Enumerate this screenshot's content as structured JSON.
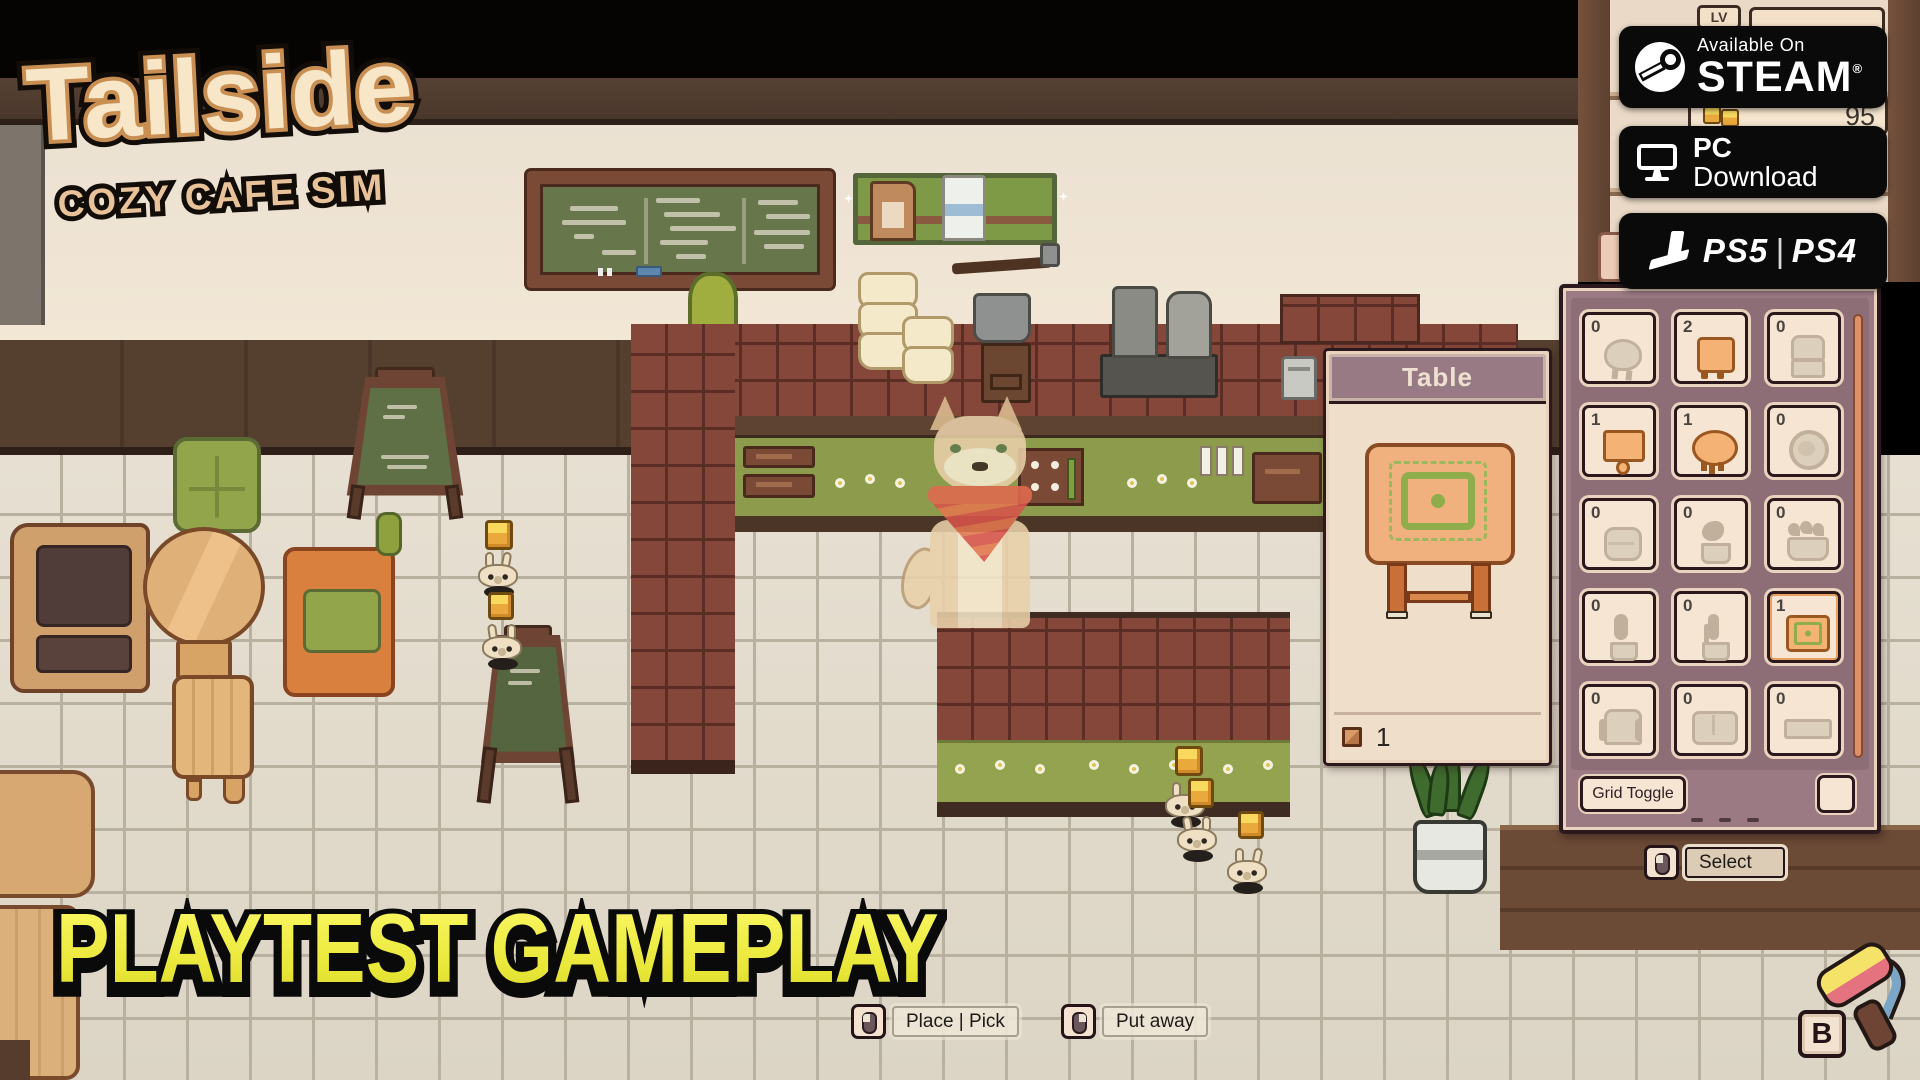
{
  "branding": {
    "logo_title": "Tailside",
    "logo_subtitle": "COZY CAFE SIM",
    "watermark": "PLAYTEST GAMEPLAY"
  },
  "platform_badges": {
    "steam": {
      "icon": "steam-logo",
      "line1": "Available On",
      "line2": "STEAM",
      "registered": "®"
    },
    "pc": {
      "icon": "monitor-icon",
      "line1": "PC",
      "line2": "Download"
    },
    "playstation": {
      "icon": "playstation-logo",
      "primary": "PS5",
      "divider": "|",
      "secondary": "PS4"
    }
  },
  "hud": {
    "level_label": "LV",
    "coin_icon": "coin-icon",
    "currency_value": "95"
  },
  "item_popup": {
    "title": "Table",
    "count_icon": "furniture-box-icon",
    "count": "1"
  },
  "inventory_panel": {
    "slots": [
      {
        "count": "0",
        "item": "stool-round",
        "state": "empty"
      },
      {
        "count": "2",
        "item": "stool-square",
        "state": "available"
      },
      {
        "count": "0",
        "item": "chair",
        "state": "empty"
      },
      {
        "count": "1",
        "item": "table-square",
        "state": "available"
      },
      {
        "count": "1",
        "item": "table-round",
        "state": "available"
      },
      {
        "count": "0",
        "item": "chair-round",
        "state": "empty"
      },
      {
        "count": "0",
        "item": "pouf",
        "state": "empty"
      },
      {
        "count": "0",
        "item": "plant-small",
        "state": "empty"
      },
      {
        "count": "0",
        "item": "planter",
        "state": "empty"
      },
      {
        "count": "0",
        "item": "plant-tall",
        "state": "empty"
      },
      {
        "count": "0",
        "item": "cactus",
        "state": "empty"
      },
      {
        "count": "1",
        "item": "table-rug",
        "state": "selected"
      },
      {
        "count": "0",
        "item": "armchair",
        "state": "empty"
      },
      {
        "count": "0",
        "item": "sofa",
        "state": "empty"
      },
      {
        "count": "0",
        "item": "bench",
        "state": "empty"
      }
    ],
    "grid_toggle_label": "Grid Toggle"
  },
  "controls": {
    "place_pick": {
      "icon": "mouse-left-click-icon",
      "label": "Place | Pick"
    },
    "put_away": {
      "icon": "mouse-right-click-icon",
      "label": "Put away"
    },
    "select": {
      "icon": "mouse-left-click-icon",
      "label": "Select"
    },
    "paint_tool": {
      "icon": "paint-roller-icon",
      "key": "B"
    }
  }
}
